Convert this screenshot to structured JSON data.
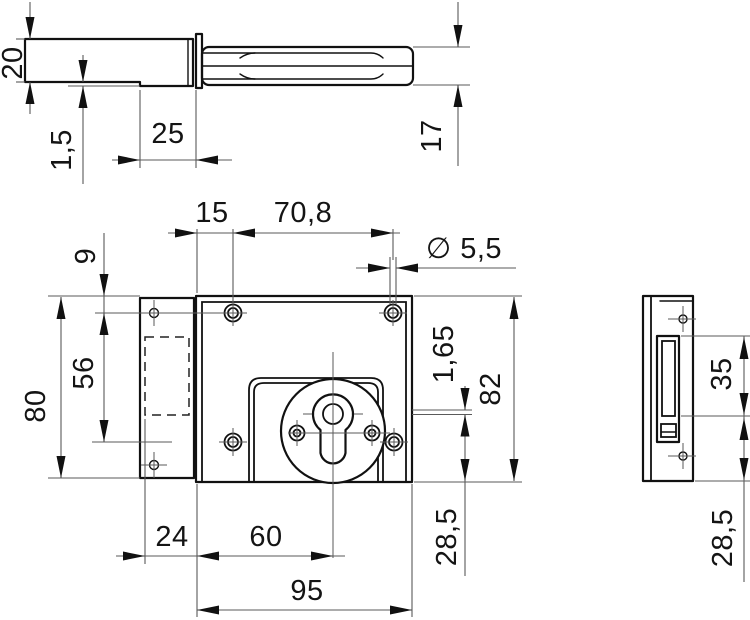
{
  "drawing": {
    "kind": "technical-drawing-lock",
    "background_color": "#ffffff",
    "line_color": "#111111",
    "dimension_line_color": "#5a5a5a",
    "views": {
      "top": {
        "title": "bolt-top-view",
        "dims": {
          "case_depth": "20",
          "plate_thickness": "1,5",
          "bolt_overlap": "25",
          "bolt_width": "17"
        }
      },
      "front": {
        "title": "lock-front-view",
        "dims": {
          "hole_edge_inset": "15",
          "hole_spacing": "70,8",
          "hole_diameter": "∅ 5,5",
          "top_to_hole": "9",
          "hole_row_spacing": "56",
          "flange_height": "80",
          "case_height": "82",
          "cover_offset": "1,65",
          "flange_width": "24",
          "edge_to_axis": "60",
          "case_width": "95",
          "axis_to_bottom": "28,5"
        }
      },
      "side": {
        "title": "strike-plate-side-view",
        "dims": {
          "slot_height": "35",
          "slot_to_bottom": "28,5"
        }
      }
    }
  }
}
